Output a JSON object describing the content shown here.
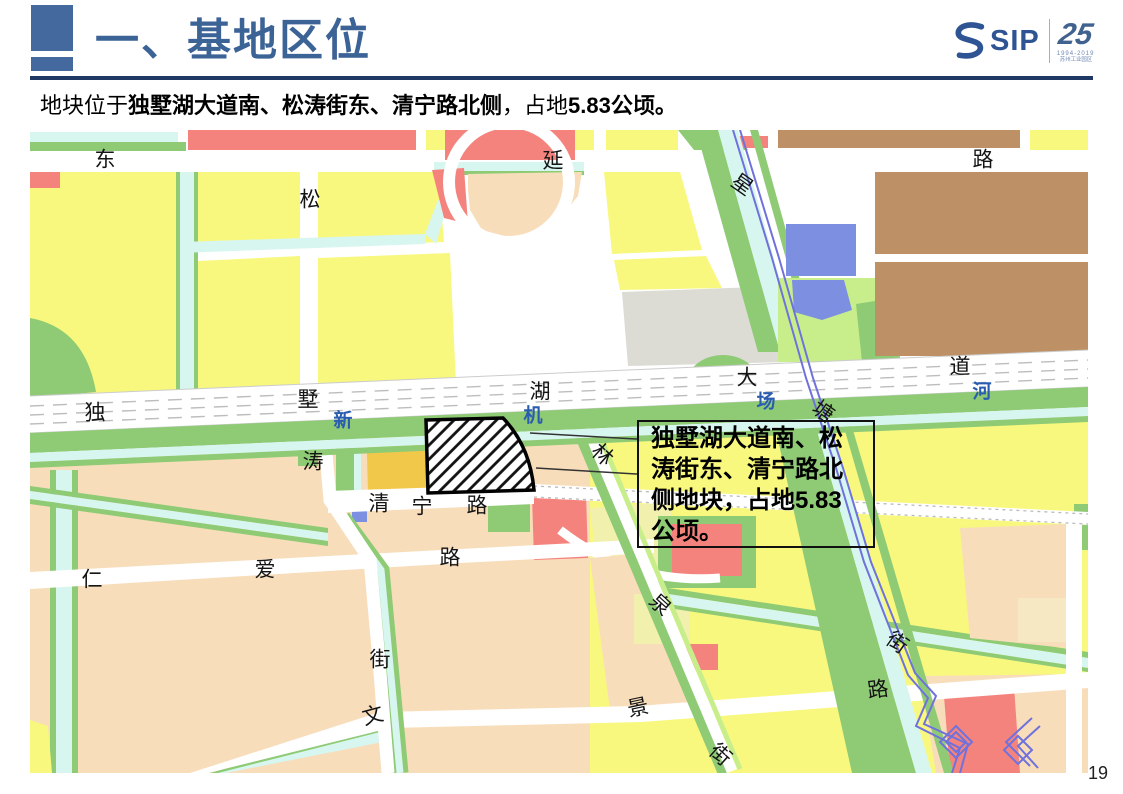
{
  "slide": {
    "title": "一、基地区位",
    "page_number": "19",
    "subtitle": {
      "prefix": "地块位于",
      "bold_roads": "独墅湖大道南、松涛街东、清宁路北侧",
      "middle": "，占地",
      "bold_area": "5.83公顷。"
    }
  },
  "logo": {
    "sip": "SIP",
    "anniversary": "25",
    "years": "1994-2019",
    "org": "苏州工业园区"
  },
  "map": {
    "callout_text": "独墅湖大道南、松涛街东、清宁路北侧地块，占地5.83公顷。",
    "site_label": "规划地块（斜线填充）",
    "labels": [
      {
        "t": "东",
        "x": 75,
        "y": 30
      },
      {
        "t": "延",
        "x": 523,
        "y": 31
      },
      {
        "t": "路",
        "x": 953,
        "y": 30
      },
      {
        "t": "松",
        "x": 280,
        "y": 70
      },
      {
        "t": "星",
        "x": 712,
        "y": 55,
        "rot": 35
      },
      {
        "t": "独",
        "x": 65,
        "y": 283
      },
      {
        "t": "墅",
        "x": 278,
        "y": 270
      },
      {
        "t": "湖",
        "x": 510,
        "y": 262
      },
      {
        "t": "大",
        "x": 717,
        "y": 248
      },
      {
        "t": "道",
        "x": 930,
        "y": 237
      },
      {
        "t": "新",
        "x": 313,
        "y": 291,
        "river": true
      },
      {
        "t": "机",
        "x": 503,
        "y": 286,
        "river": true
      },
      {
        "t": "场",
        "x": 736,
        "y": 272,
        "river": true
      },
      {
        "t": "河",
        "x": 952,
        "y": 262,
        "river": true
      },
      {
        "t": "涛",
        "x": 283,
        "y": 332
      },
      {
        "t": "塘",
        "x": 793,
        "y": 282,
        "rot": 35
      },
      {
        "t": "林",
        "x": 572,
        "y": 325,
        "rot": 42
      },
      {
        "t": "清",
        "x": 349,
        "y": 374
      },
      {
        "t": "宁",
        "x": 392,
        "y": 377
      },
      {
        "t": "路",
        "x": 447,
        "y": 376
      },
      {
        "t": "仁",
        "x": 62,
        "y": 450
      },
      {
        "t": "爱",
        "x": 235,
        "y": 440
      },
      {
        "t": "路",
        "x": 420,
        "y": 428
      },
      {
        "t": "泉",
        "x": 630,
        "y": 475,
        "rot": 42
      },
      {
        "t": "街",
        "x": 350,
        "y": 530
      },
      {
        "t": "街",
        "x": 867,
        "y": 513,
        "rot": 35
      },
      {
        "t": "文",
        "x": 343,
        "y": 586,
        "rot": -15
      },
      {
        "t": "景",
        "x": 608,
        "y": 578,
        "rot": -12
      },
      {
        "t": "路",
        "x": 848,
        "y": 560,
        "rot": -8
      },
      {
        "t": "街",
        "x": 690,
        "y": 625,
        "rot": 42
      }
    ],
    "palette": {
      "residential_yellow": "#F8F87E",
      "residential_tan": "#F8DDBB",
      "industrial_brown": "#BD9165",
      "commercial_red": "#F5837D",
      "education_blue": "#7D8FE0",
      "special_gray": "#DCDCD5",
      "mixed_gold": "#F2C84B",
      "park_green": "#8FCA75",
      "park_lightgreen": "#C8EE8C",
      "water_cyan": "#D8F6F0",
      "river_purple": "#6F71DC",
      "road_white": "#FFFFFF"
    }
  },
  "colors": {
    "accent_blue": "#2E5494",
    "title_blue": "#3C6396",
    "rule_navy": "#1F3864",
    "header_square": "#44699E"
  }
}
